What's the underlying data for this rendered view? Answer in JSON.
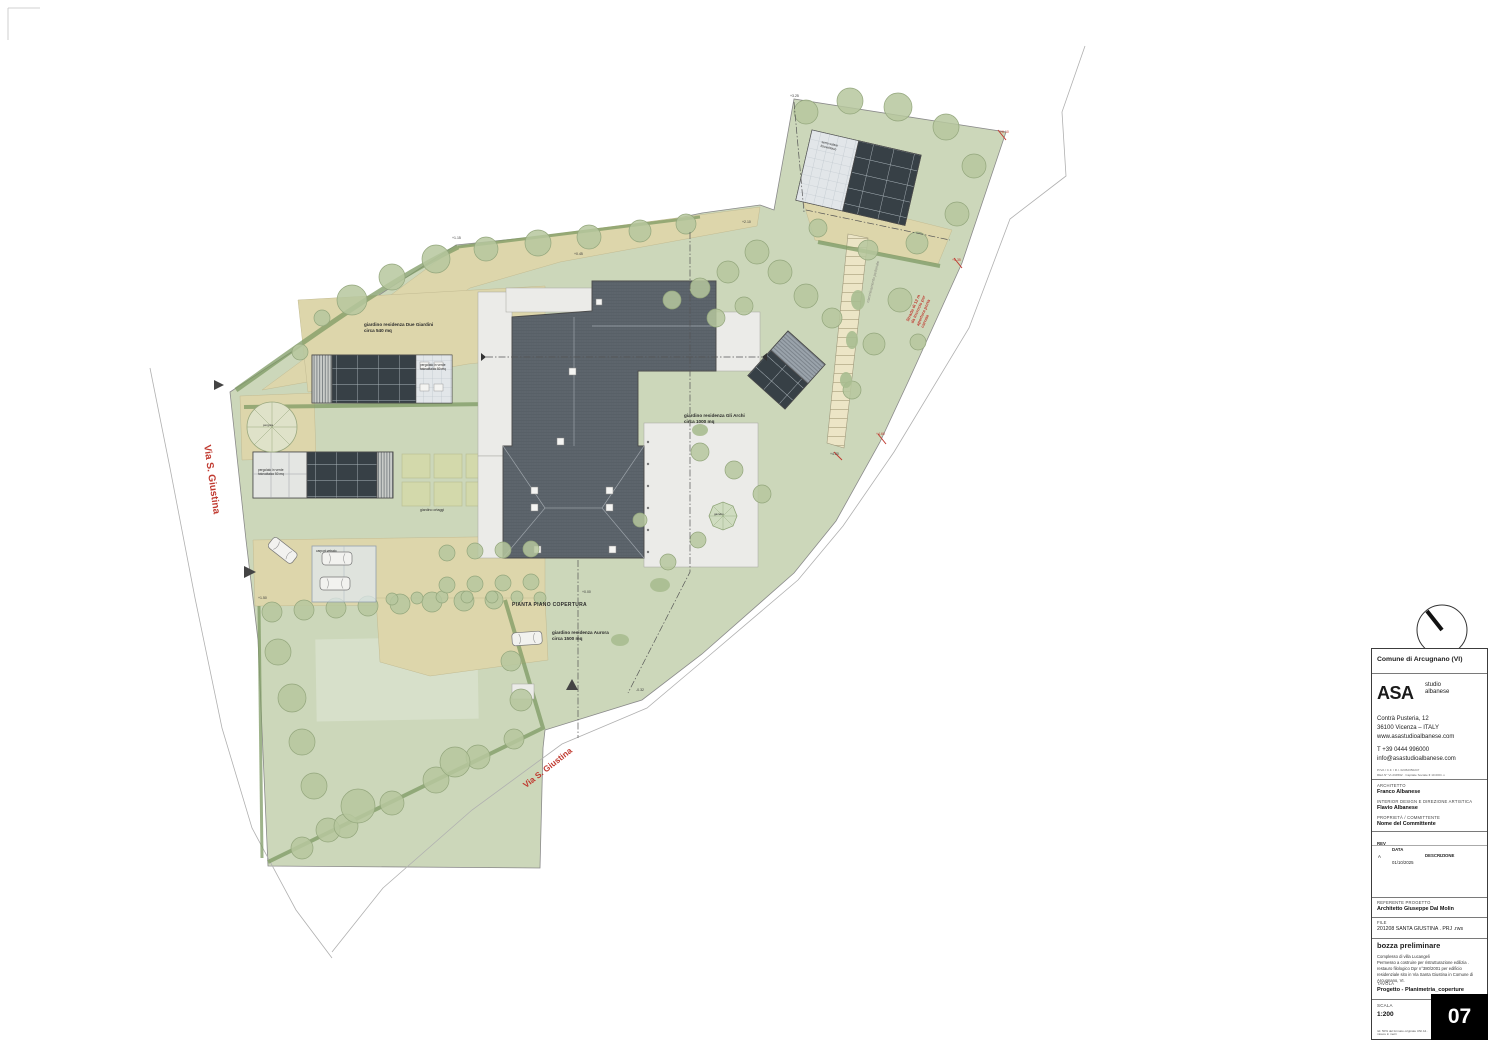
{
  "plan": {
    "title": "PIANTA PIANO COPERTURA",
    "streets": {
      "left": "Via S. Giustina",
      "bottom": "Via S. Giustina"
    },
    "road_note": "Strada di 12 m\nda incrocio per\napertura porta\ncarraia",
    "path_note": "camminamento pedonale",
    "gardens": {
      "due_giardini": "giardino residenza Due Giardini\ncirca 540 mq",
      "gli_archi": "giardino residenza Gli Archi\ncirca 1000 mq",
      "aurora": "giardino residenza Aurora\ncirca 1500 mq",
      "ortaggi": "giardino ortaggi"
    },
    "features": {
      "pergola_a": "pergolato in verde\nfotovoltaico 50 mq",
      "pergola_b": "pergolato in verde\nfotovoltaico 50 mq",
      "serra": "serra solare\nfotovoltaico",
      "carport": "carport vetrato",
      "gazebo": "gazebo",
      "pergola_round": "pergola"
    },
    "spots": [
      {
        "v": "+1.15"
      },
      {
        "v": "+0.45"
      },
      {
        "v": "+2.10"
      },
      {
        "v": "+3.25"
      },
      {
        "v": "+6.10"
      },
      {
        "v": "+5.35"
      },
      {
        "v": "+4.60"
      },
      {
        "v": "+4.20"
      },
      {
        "v": "+0.00"
      },
      {
        "v": "-0.32"
      },
      {
        "v": "+1.50"
      }
    ]
  },
  "title_block": {
    "comune": "Comune di Arcugnano (VI)",
    "logo_main": "ASA",
    "logo_sub": "studio\nalbanese",
    "address": "Contrà Pusteria, 12\n36100 Vicenza – ITALY\nwww.asastudioalbanese.com",
    "contacts": "T  +39 0444 996000\ninfo@asastudioalbanese.com",
    "fiscal": "P.IVA / C.F. / R.I. 02452350247\nREA N° VI-234562 · Capitale Sociale € 10.000 i.v.",
    "architetto_label": "ARCHITETTO",
    "architetto": "Franco Albanese",
    "interior_label": "INTERIOR DESIGN E DIREZIONE ARTISTICA",
    "interior": "Flavio Albanese",
    "proprieta_label": "PROPRIETÀ / COMMITTENTE",
    "proprieta": "Nome del Committente",
    "rev_header": {
      "rev": "REV",
      "data": "DATA",
      "desc": "DESCRIZIONE"
    },
    "rev_rows": [
      {
        "rev": "A",
        "data": "01/10/2025",
        "desc": ""
      }
    ],
    "referente_label": "REFERENTE PROGETTO",
    "referente": "Architetto Giuseppe Dal Molin",
    "file_label": "FILE",
    "file": "201208    SANTA GIUSTINA . PRJ .rws",
    "status": "bozza preliminare",
    "description": "Complesso di villa Lucangeli\nPermesso a costruire per ristrutturazione edilizia .\nrestauro filologico Dpr n°380/2001 per edificio\nresidenziale sito in Via Santa Giustina in Comune di\nArcugnano, VI.",
    "tavola_label": "TAVOLA",
    "tavola": "Progetto - Planimetria_coperture",
    "scala_label": "SCALA",
    "scala": "1:200",
    "sheet_number": "07",
    "footer_note": "rid. 50% del formato originale UNI A1 · misure in metri"
  },
  "colors": {
    "lawn": "#ccd7ba",
    "tan": "#ddd6ab",
    "roof": "#626a72",
    "solar": "#374046",
    "accent_red": "#c03a30"
  }
}
